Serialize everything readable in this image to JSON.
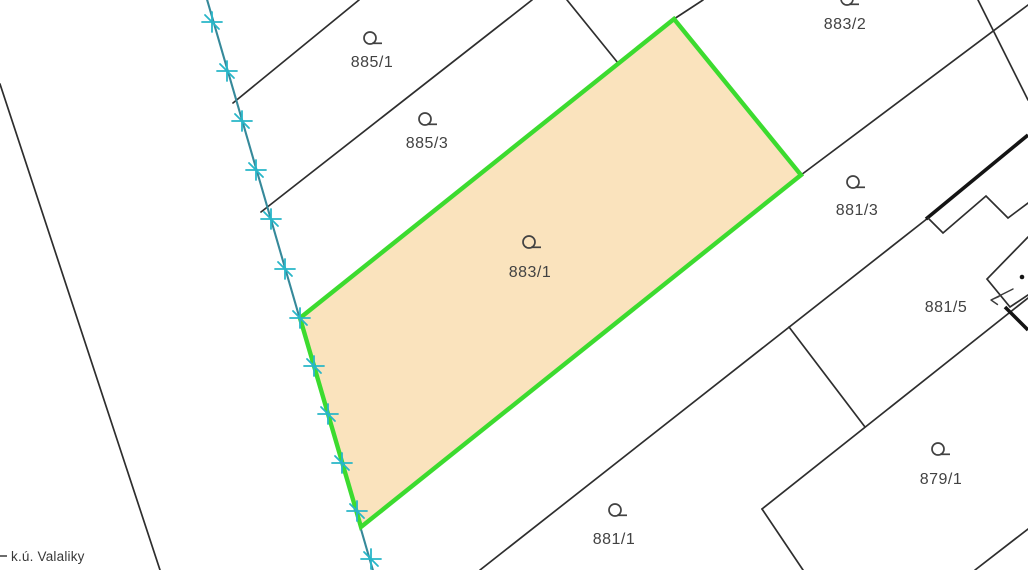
{
  "map": {
    "type": "cadastral-parcel-map",
    "cadastral_unit_label": "k.ú. Valaliky",
    "highlighted_parcel": "883/1",
    "parcels": [
      {
        "number": "885/1",
        "symbol": "land-use-symbol"
      },
      {
        "number": "885/3",
        "symbol": "land-use-symbol"
      },
      {
        "number": "883/1",
        "symbol": "land-use-symbol",
        "highlighted": true
      },
      {
        "number": "883/2",
        "symbol": "land-use-symbol"
      },
      {
        "number": "881/3",
        "symbol": "land-use-symbol"
      },
      {
        "number": "881/5",
        "symbol": "none",
        "pointer_arrow": true
      },
      {
        "number": "881/1",
        "symbol": "land-use-symbol"
      },
      {
        "number": "879/1",
        "symbol": "land-use-symbol"
      }
    ],
    "colors": {
      "background": "#ffffff",
      "parcel-line": "#2e2e2e",
      "building-line": "#141414",
      "highlight-fill": "#fae3bd",
      "highlight-stroke": "#3cdb2f",
      "boundary-line": "#36899a",
      "boundary-marker": "#28b6c8",
      "label-text": "#424242"
    }
  }
}
